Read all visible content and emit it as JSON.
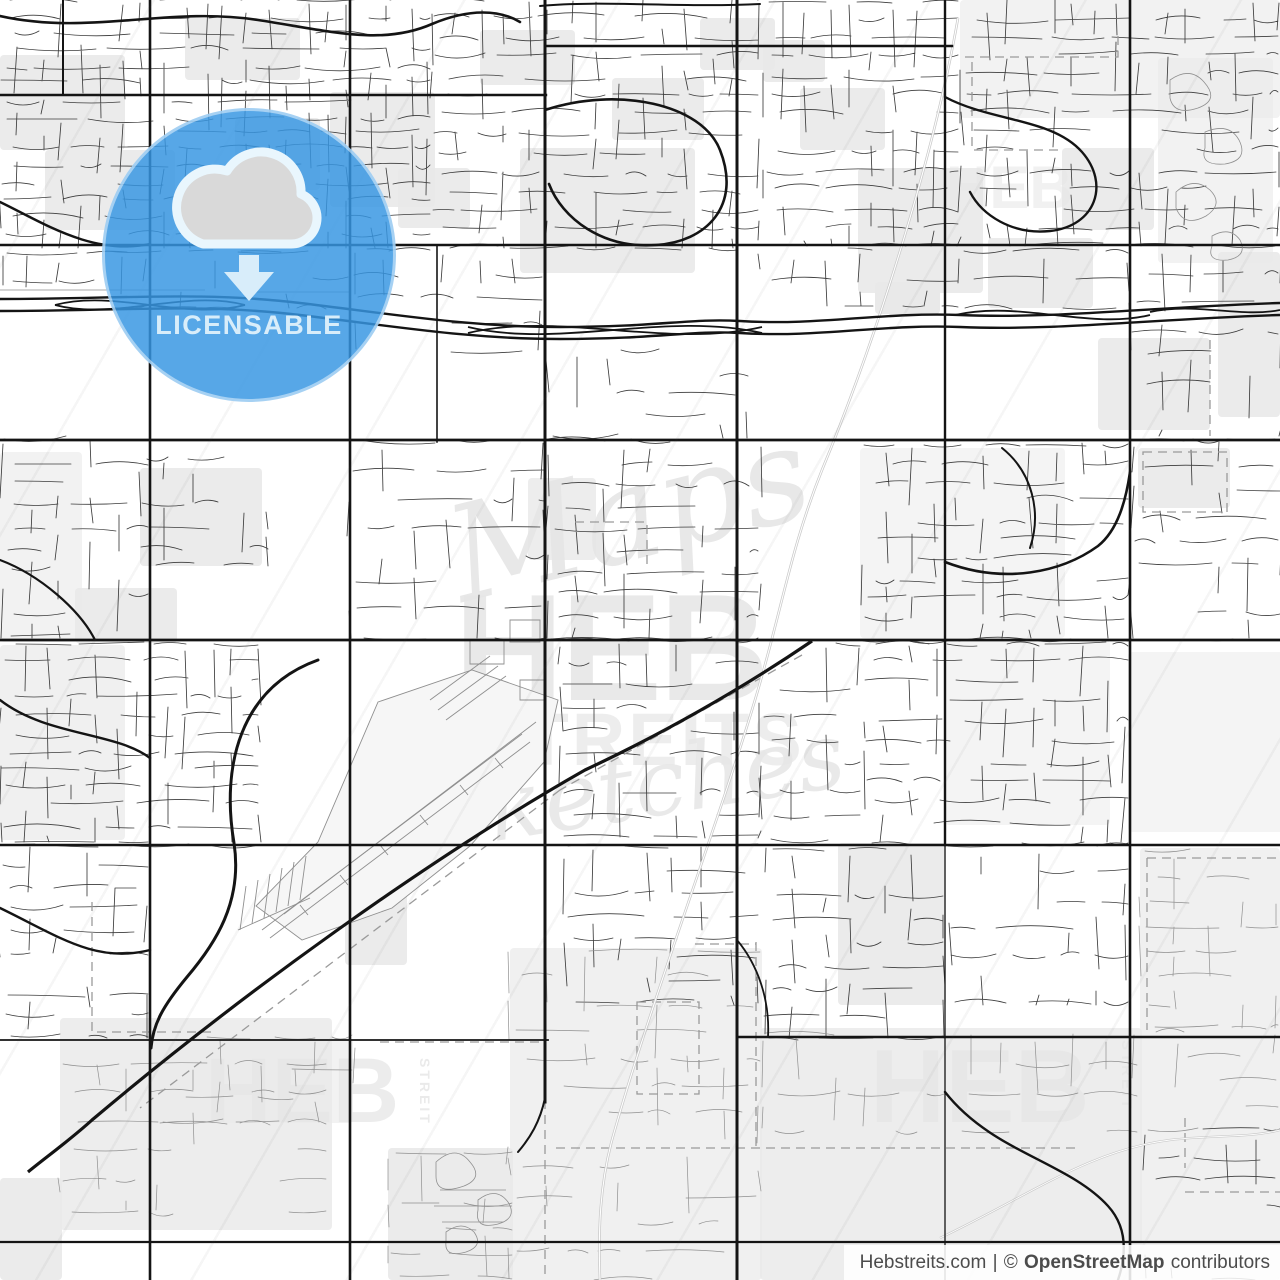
{
  "poster": {
    "kind": "city-street-map-preview"
  },
  "badge": {
    "label": "LICENSABLE",
    "icon": "cloud-download-icon",
    "circle_color": "rgba(55,150,226,0.84)",
    "accent_color": "#d8edfa",
    "cloud_fill": "#d9d9d9",
    "cloud_outline": "#e9f6fd"
  },
  "watermark": {
    "center": {
      "script_top": "Maps",
      "brand": "HEB",
      "brand_sub": "STREITS",
      "script_bottom": "Sketches"
    },
    "tiles": {
      "brand": "HEB",
      "side_label": "STREIT"
    }
  },
  "attribution": {
    "site": "Hebstreits.com",
    "divider": "|",
    "copyright": "©",
    "source": "OpenStreetMap",
    "suffix": "contributors",
    "text_color": "#4c4c4c",
    "background": "rgba(255,255,255,0.87)"
  },
  "map": {
    "background": "#ffffff",
    "major_road_color": "#141414",
    "minor_road_color": "#3c3c3c",
    "rural_road_color": "#8f8f8f",
    "landuse_color": "#e9e9e9",
    "boundary_color": "#9a9a9a",
    "water_color": "#c9c9c9",
    "watermark_color": "#e6e6e6"
  }
}
